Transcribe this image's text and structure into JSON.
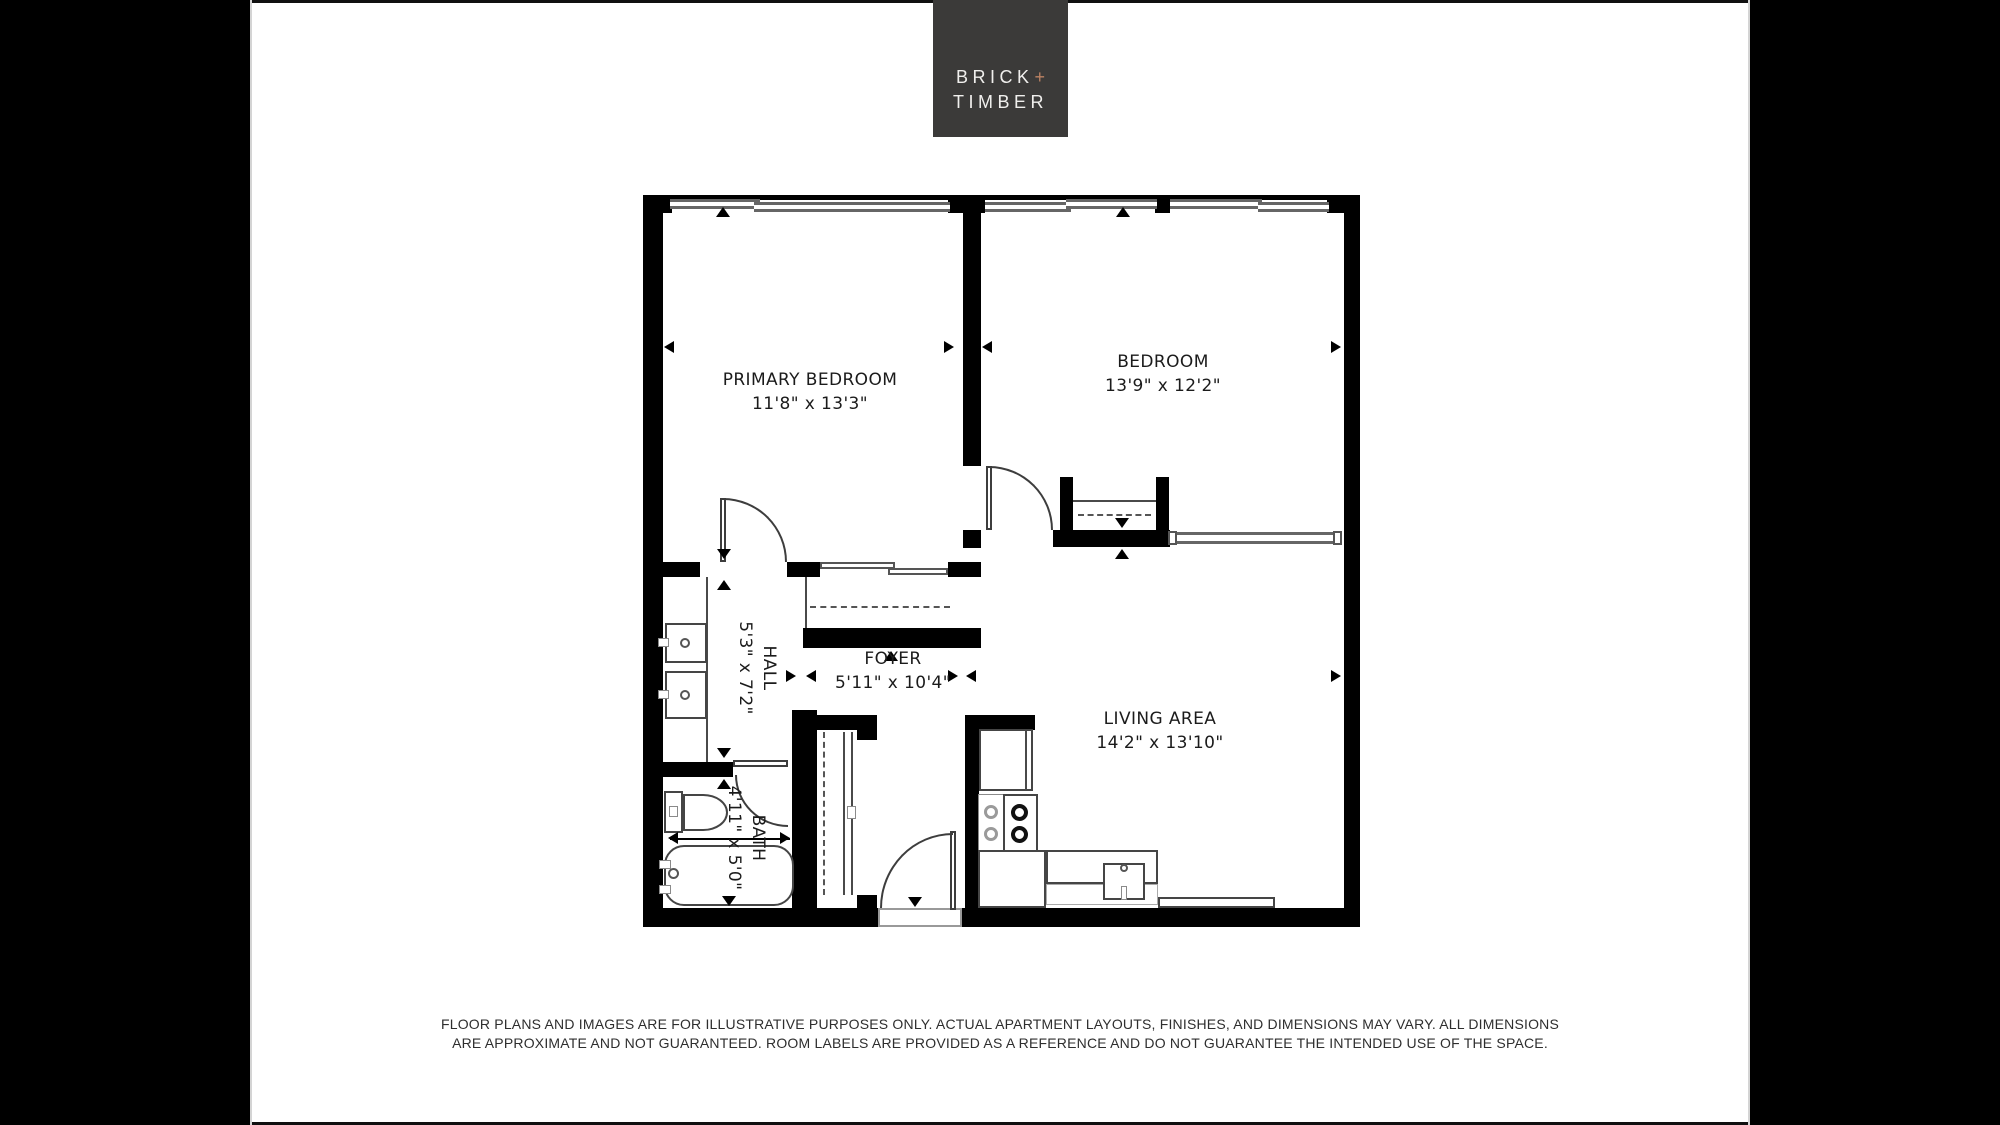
{
  "brand": {
    "line1": "BRICK",
    "plus": "+",
    "line2": "TIMBER",
    "box_color": "#3b3a39",
    "plus_color": "#bc8263"
  },
  "rooms": {
    "primary_bedroom": {
      "name": "PRIMARY BEDROOM",
      "dimensions": "11'8\" x 13'3\""
    },
    "bedroom": {
      "name": "BEDROOM",
      "dimensions": "13'9\" x 12'2\""
    },
    "hall": {
      "name": "HALL",
      "dimensions": "5'3\" x 7'2\""
    },
    "foyer": {
      "name": "FOYER",
      "dimensions": "5'11\" x 10'4\""
    },
    "bath": {
      "name": "BATH",
      "dimensions": "4'11\" x 5'0\""
    },
    "living_area": {
      "name": "LIVING AREA",
      "dimensions": "14'2\" x 13'10\""
    }
  },
  "disclaimer": {
    "line1": "FLOOR PLANS AND IMAGES ARE FOR ILLUSTRATIVE PURPOSES ONLY. ACTUAL APARTMENT LAYOUTS, FINISHES, AND DIMENSIONS MAY VARY. ALL DIMENSIONS",
    "line2": "ARE APPROXIMATE AND NOT GUARANTEED. ROOM LABELS ARE PROVIDED AS A REFERENCE AND DO NOT GUARANTEE THE INTENDED USE OF THE SPACE."
  },
  "colors": {
    "wall": "#000000",
    "window_line": "#666666",
    "fixture_line": "#454545",
    "side_bar": "#000000"
  }
}
